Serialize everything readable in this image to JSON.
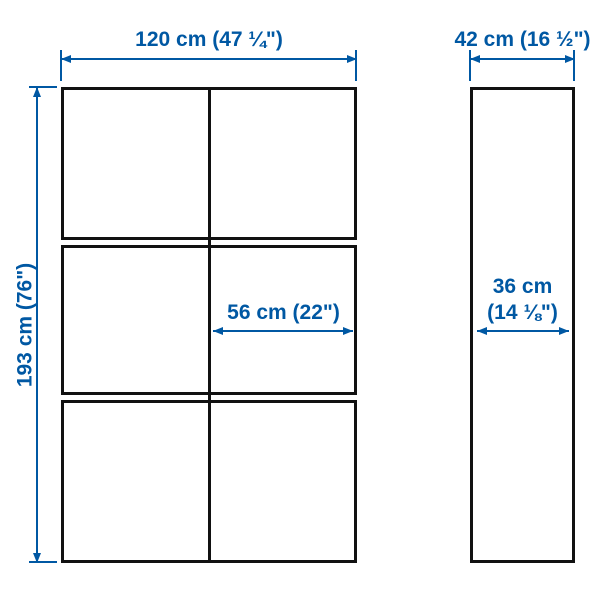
{
  "diagram": {
    "front_view": {
      "width_label": "120 cm (47 ¼\")",
      "height_label": "193 cm (76\")",
      "compartment_width_label": "56 cm (22\")",
      "grid": {
        "columns": 2,
        "rows": 3
      }
    },
    "side_view": {
      "depth_label": "42 cm (16 ½\")",
      "inner_depth_label_line1": "36 cm",
      "inner_depth_label_line2": "(14 ⅛\")"
    },
    "colors": {
      "dimension_blue": "#0058a3",
      "outline_black": "#111111",
      "background": "#ffffff"
    }
  }
}
